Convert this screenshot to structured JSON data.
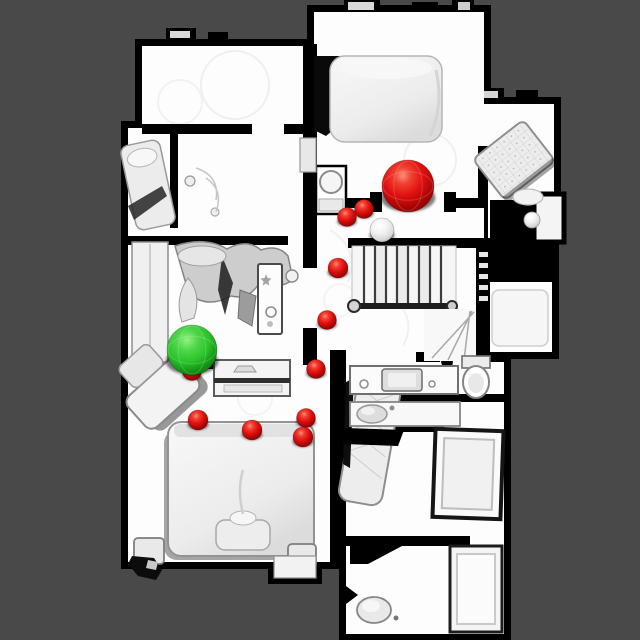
{
  "scene": {
    "colors": {
      "background": "#494949",
      "floor": "#ffffff",
      "walls": "#000000",
      "waypoint_red": "#e01010",
      "target_red": "#e01010",
      "goal_green": "#2cc42c",
      "neutral_sphere": "#ededed"
    }
  },
  "markers": {
    "target_sphere": {
      "name": "target-sphere",
      "kind": "red-large",
      "x": 408,
      "y": 186,
      "r": 26
    },
    "goal_sphere": {
      "name": "goal-sphere",
      "kind": "green-large",
      "x": 192,
      "y": 350,
      "r": 25
    },
    "white_sphere": {
      "name": "white-sphere",
      "kind": "white-small",
      "x": 382,
      "y": 230,
      "r": 12
    },
    "waypoints": [
      {
        "x": 364,
        "y": 209,
        "r": 9.5
      },
      {
        "x": 347,
        "y": 217,
        "r": 9.5
      },
      {
        "x": 338,
        "y": 268,
        "r": 10
      },
      {
        "x": 327,
        "y": 320,
        "r": 9.5
      },
      {
        "x": 316,
        "y": 369,
        "r": 9.5
      },
      {
        "x": 306,
        "y": 418,
        "r": 9.5
      },
      {
        "x": 303,
        "y": 437,
        "r": 10
      },
      {
        "x": 252,
        "y": 430,
        "r": 10
      },
      {
        "x": 198,
        "y": 420,
        "r": 10
      },
      {
        "x": 192,
        "y": 371,
        "r": 9.5
      }
    ]
  }
}
